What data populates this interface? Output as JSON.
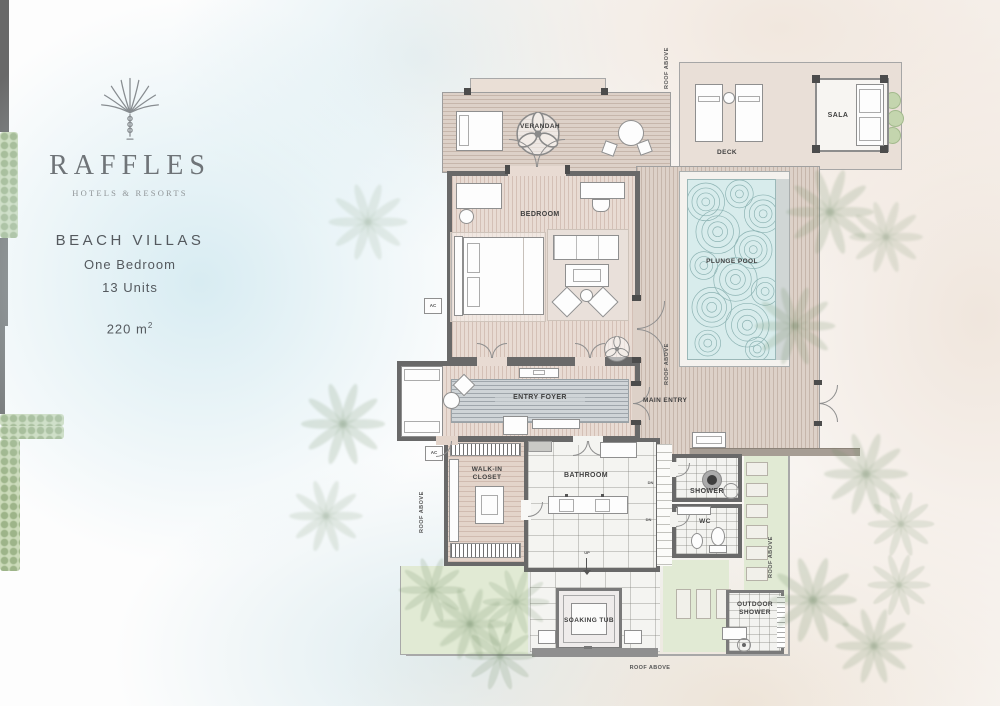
{
  "brand": {
    "name": "RAFFLES",
    "tagline": "HOTELS & RESORTS"
  },
  "info": {
    "heading": "BEACH VILLAS",
    "subtitle_line1": "One Bedroom",
    "subtitle_line2": "13 Units",
    "area": "220 m",
    "area_sup": "2"
  },
  "plan": {
    "rooms": {
      "verandah": "VERANDAH",
      "deck": "DECK",
      "sala": "SALA",
      "bedroom": "BEDROOM",
      "plunge_pool": "PLUNGE POOL",
      "entry_foyer": "ENTRY FOYER",
      "main_entry": "MAIN ENTRY",
      "walk_in_closet": "WALK-IN CLOSET",
      "bathroom": "BATHROOM",
      "shower": "SHOWER",
      "wc": "WC",
      "soaking_tub": "SOAKING TUB",
      "outdoor_shower": "OUTDOOR SHOWER"
    },
    "annotations": {
      "roof_above": "ROOF ABOVE",
      "ac": "AC",
      "dn": "DN",
      "up": "UP"
    }
  },
  "colors": {
    "sand": "#f2e9e1",
    "sea_wash": "#d9edf3",
    "pool_water": "#d8ecec",
    "deck_wood": "#ddd1c8",
    "room_wood": "#e8dbd3",
    "wall_gray": "#696969",
    "lawn": "#e1ead4",
    "hedge": "#ccdbba",
    "label": "#3f3f3f",
    "brand_gray": "#6f7478"
  }
}
